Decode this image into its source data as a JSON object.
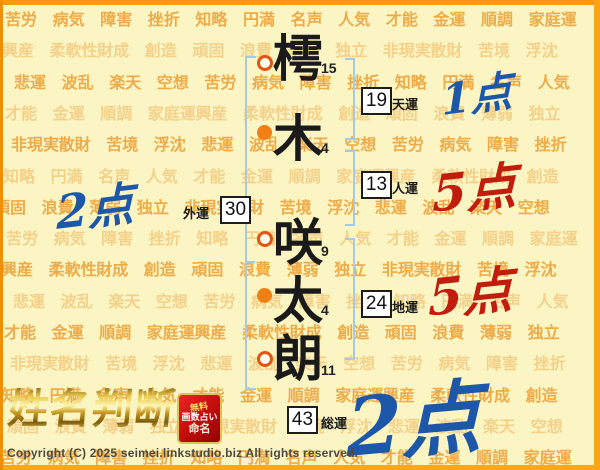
{
  "colors": {
    "page_bg": "#fbf5c3",
    "frame_orange": "#f79c10",
    "bracket_blue": "#a3cbe9",
    "score_blue": "#1c57a9",
    "score_red": "#c01d0c",
    "marker_orange": "#f08014",
    "marker_ring": "#e25410",
    "bg_word_dark": "#eeab49",
    "bg_word_light": "#f4d18a",
    "logo_gold": "#d4a017",
    "badge_red": "#c90f0f"
  },
  "background": {
    "words": [
      "苦労",
      "病気",
      "障害",
      "挫折",
      "知略",
      "円満",
      "名声",
      "人気",
      "才能",
      "金運",
      "順調",
      "家庭運",
      "興産",
      "柔軟性",
      "財成",
      "創造",
      "頑固",
      "浪費",
      "薄弱",
      "独立",
      "非現実",
      "散財",
      "苦境",
      "浮沈",
      "悲運",
      "波乱",
      "楽天",
      "空想"
    ]
  },
  "name": {
    "characters": [
      {
        "char": "樗",
        "strokes": "15",
        "marker": "ring"
      },
      {
        "char": "木",
        "strokes": "4",
        "marker": "dot"
      },
      {
        "char": "咲",
        "strokes": "9",
        "marker": "ring"
      },
      {
        "char": "太",
        "strokes": "4",
        "marker": "dot"
      },
      {
        "char": "朗",
        "strokes": "11",
        "marker": "ring"
      }
    ]
  },
  "fortunes": {
    "tenun": {
      "label": "天運",
      "value": "19",
      "score": "1点",
      "score_color": "blue"
    },
    "jinun": {
      "label": "人運",
      "value": "13",
      "score": "5点",
      "score_color": "red"
    },
    "chiun": {
      "label": "地運",
      "value": "24",
      "score": "5点",
      "score_color": "red"
    },
    "gaiun": {
      "label": "外運",
      "value": "30",
      "score": "2点",
      "score_color": "blue"
    },
    "soun": {
      "label": "総運",
      "value": "43",
      "score": "2点",
      "score_color": "blue"
    }
  },
  "logo": {
    "title": "姓名判断",
    "badge": [
      "無料",
      "画数占い",
      "命名"
    ]
  },
  "footer": {
    "copyright": "Copyright (C) 2025 seimei.linkstudio.biz All rights reserved."
  }
}
